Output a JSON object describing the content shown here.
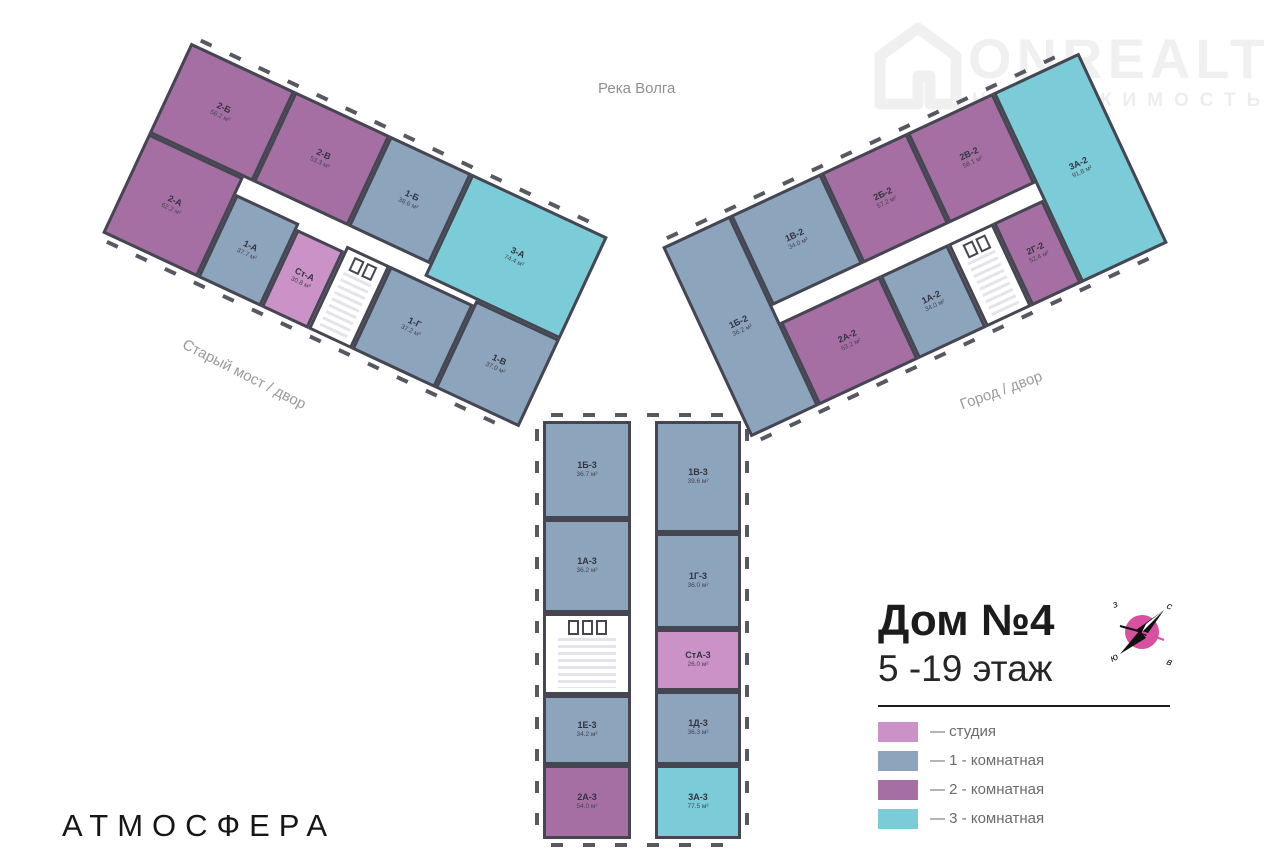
{
  "watermark": {
    "brand": "ONREALT",
    "tagline": "НЕДВИЖИМОСТЬ"
  },
  "map_labels": {
    "river": "Река Волга",
    "street_left": "Старый мост / двор",
    "street_right": "Город / двор"
  },
  "title_block": {
    "heading": "Дом №4",
    "subheading": "5 -19 этаж"
  },
  "legend": {
    "items": [
      {
        "label": "— студия",
        "color_key": "studio"
      },
      {
        "label": "— 1 - комнатная",
        "color_key": "room1"
      },
      {
        "label": "— 2 - комнатная",
        "color_key": "room2"
      },
      {
        "label": "— 3 - комнатная",
        "color_key": "room3"
      }
    ]
  },
  "compass": {
    "nw": "з",
    "ne": "с",
    "sw": "ю",
    "se": "в"
  },
  "footer": {
    "brand": "АТМОСФЕРА"
  },
  "colors": {
    "studio": "#cb92c7",
    "room1": "#8da4bd",
    "room2": "#a66fa4",
    "room3": "#7bcbd8",
    "wall": "#454651",
    "compassPink": "#d8509f"
  },
  "buildings": {
    "left": {
      "apartments": {
        "a2b": {
          "name": "2-Б",
          "area": "56.2 м²"
        },
        "a2v": {
          "name": "2-В",
          "area": "53.3 м²"
        },
        "a1b": {
          "name": "1-Б",
          "area": "38.6 м²"
        },
        "a3a": {
          "name": "3-А",
          "area": "74.4 м²"
        },
        "a2a": {
          "name": "2-А",
          "area": "62.2 м²"
        },
        "a1a": {
          "name": "1-А",
          "area": "37.7 м²"
        },
        "ast": {
          "name": "Ст-А",
          "area": "30.8 м²"
        },
        "a1g": {
          "name": "1-Г",
          "area": "37.2 м²"
        },
        "a1v": {
          "name": "1-В",
          "area": "37.0 м²"
        }
      }
    },
    "right": {
      "apartments": {
        "a1b": {
          "name": "1Б-2",
          "area": "36.2 м²"
        },
        "a1v": {
          "name": "1В-2",
          "area": "34.0 м²"
        },
        "a2b": {
          "name": "2Б-2",
          "area": "57.2 м²"
        },
        "a2v": {
          "name": "2В-2",
          "area": "58.1 м²"
        },
        "a3a": {
          "name": "3А-2",
          "area": "91.8 м²"
        },
        "a2a": {
          "name": "2А-2",
          "area": "63.2 м²"
        },
        "a1a": {
          "name": "1А-2",
          "area": "34.0 м²"
        },
        "a2g": {
          "name": "2Г-2",
          "area": "52.4 м²"
        }
      }
    },
    "bottom": {
      "apartments": {
        "a1b": {
          "name": "1Б-3",
          "area": "36.7 м²"
        },
        "a1v": {
          "name": "1В-3",
          "area": "39.6 м²"
        },
        "a1a": {
          "name": "1А-3",
          "area": "36.2 м²"
        },
        "a1g": {
          "name": "1Г-3",
          "area": "36.0 м²"
        },
        "ast": {
          "name": "СтА-3",
          "area": "26.0 м²"
        },
        "a1d": {
          "name": "1Д-3",
          "area": "36.3 м²"
        },
        "a1e": {
          "name": "1Е-3",
          "area": "34.2 м²"
        },
        "a2a": {
          "name": "2А-3",
          "area": "54.0 м²"
        },
        "a3a": {
          "name": "3А-3",
          "area": "77.5 м²"
        }
      }
    }
  }
}
